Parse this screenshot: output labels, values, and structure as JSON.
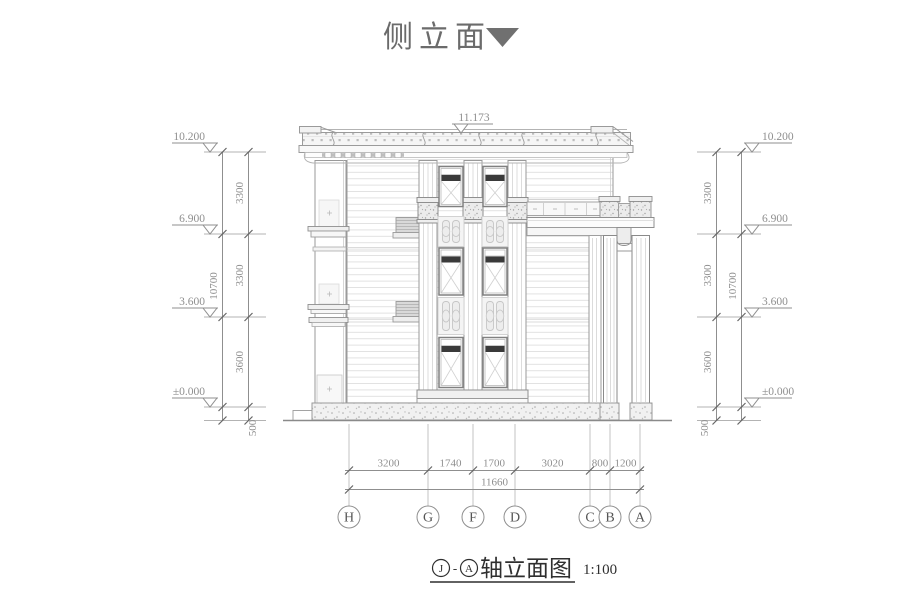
{
  "title": {
    "text": "侧立面"
  },
  "drawing": {
    "top_elevation": "11.173",
    "levels": [
      {
        "label": "10.200"
      },
      {
        "label": "6.900"
      },
      {
        "label": "3.600"
      },
      {
        "label": "±0.000"
      }
    ],
    "vdims": {
      "seg0": "3300",
      "seg1": "3300",
      "seg2": "3600",
      "plinth": "500",
      "total": "10700"
    },
    "hdims": {
      "seg0": "3200",
      "seg1": "1740",
      "seg2": "1700",
      "seg3": "3020",
      "seg4": "800",
      "seg5": "1200",
      "total": "11660"
    },
    "axes": [
      {
        "label": "H"
      },
      {
        "label": "G"
      },
      {
        "label": "F"
      },
      {
        "label": "D"
      },
      {
        "label": "C"
      },
      {
        "label": "B"
      },
      {
        "label": "A"
      }
    ]
  },
  "caption": {
    "axis_from": "J",
    "separator": "-",
    "axis_to": "A",
    "name": "轴立面图",
    "scale": "1:100"
  },
  "colors": {
    "accent_dark": "#3a3a3a",
    "line": "#8f8f8f",
    "title": "#6b6b6b"
  }
}
